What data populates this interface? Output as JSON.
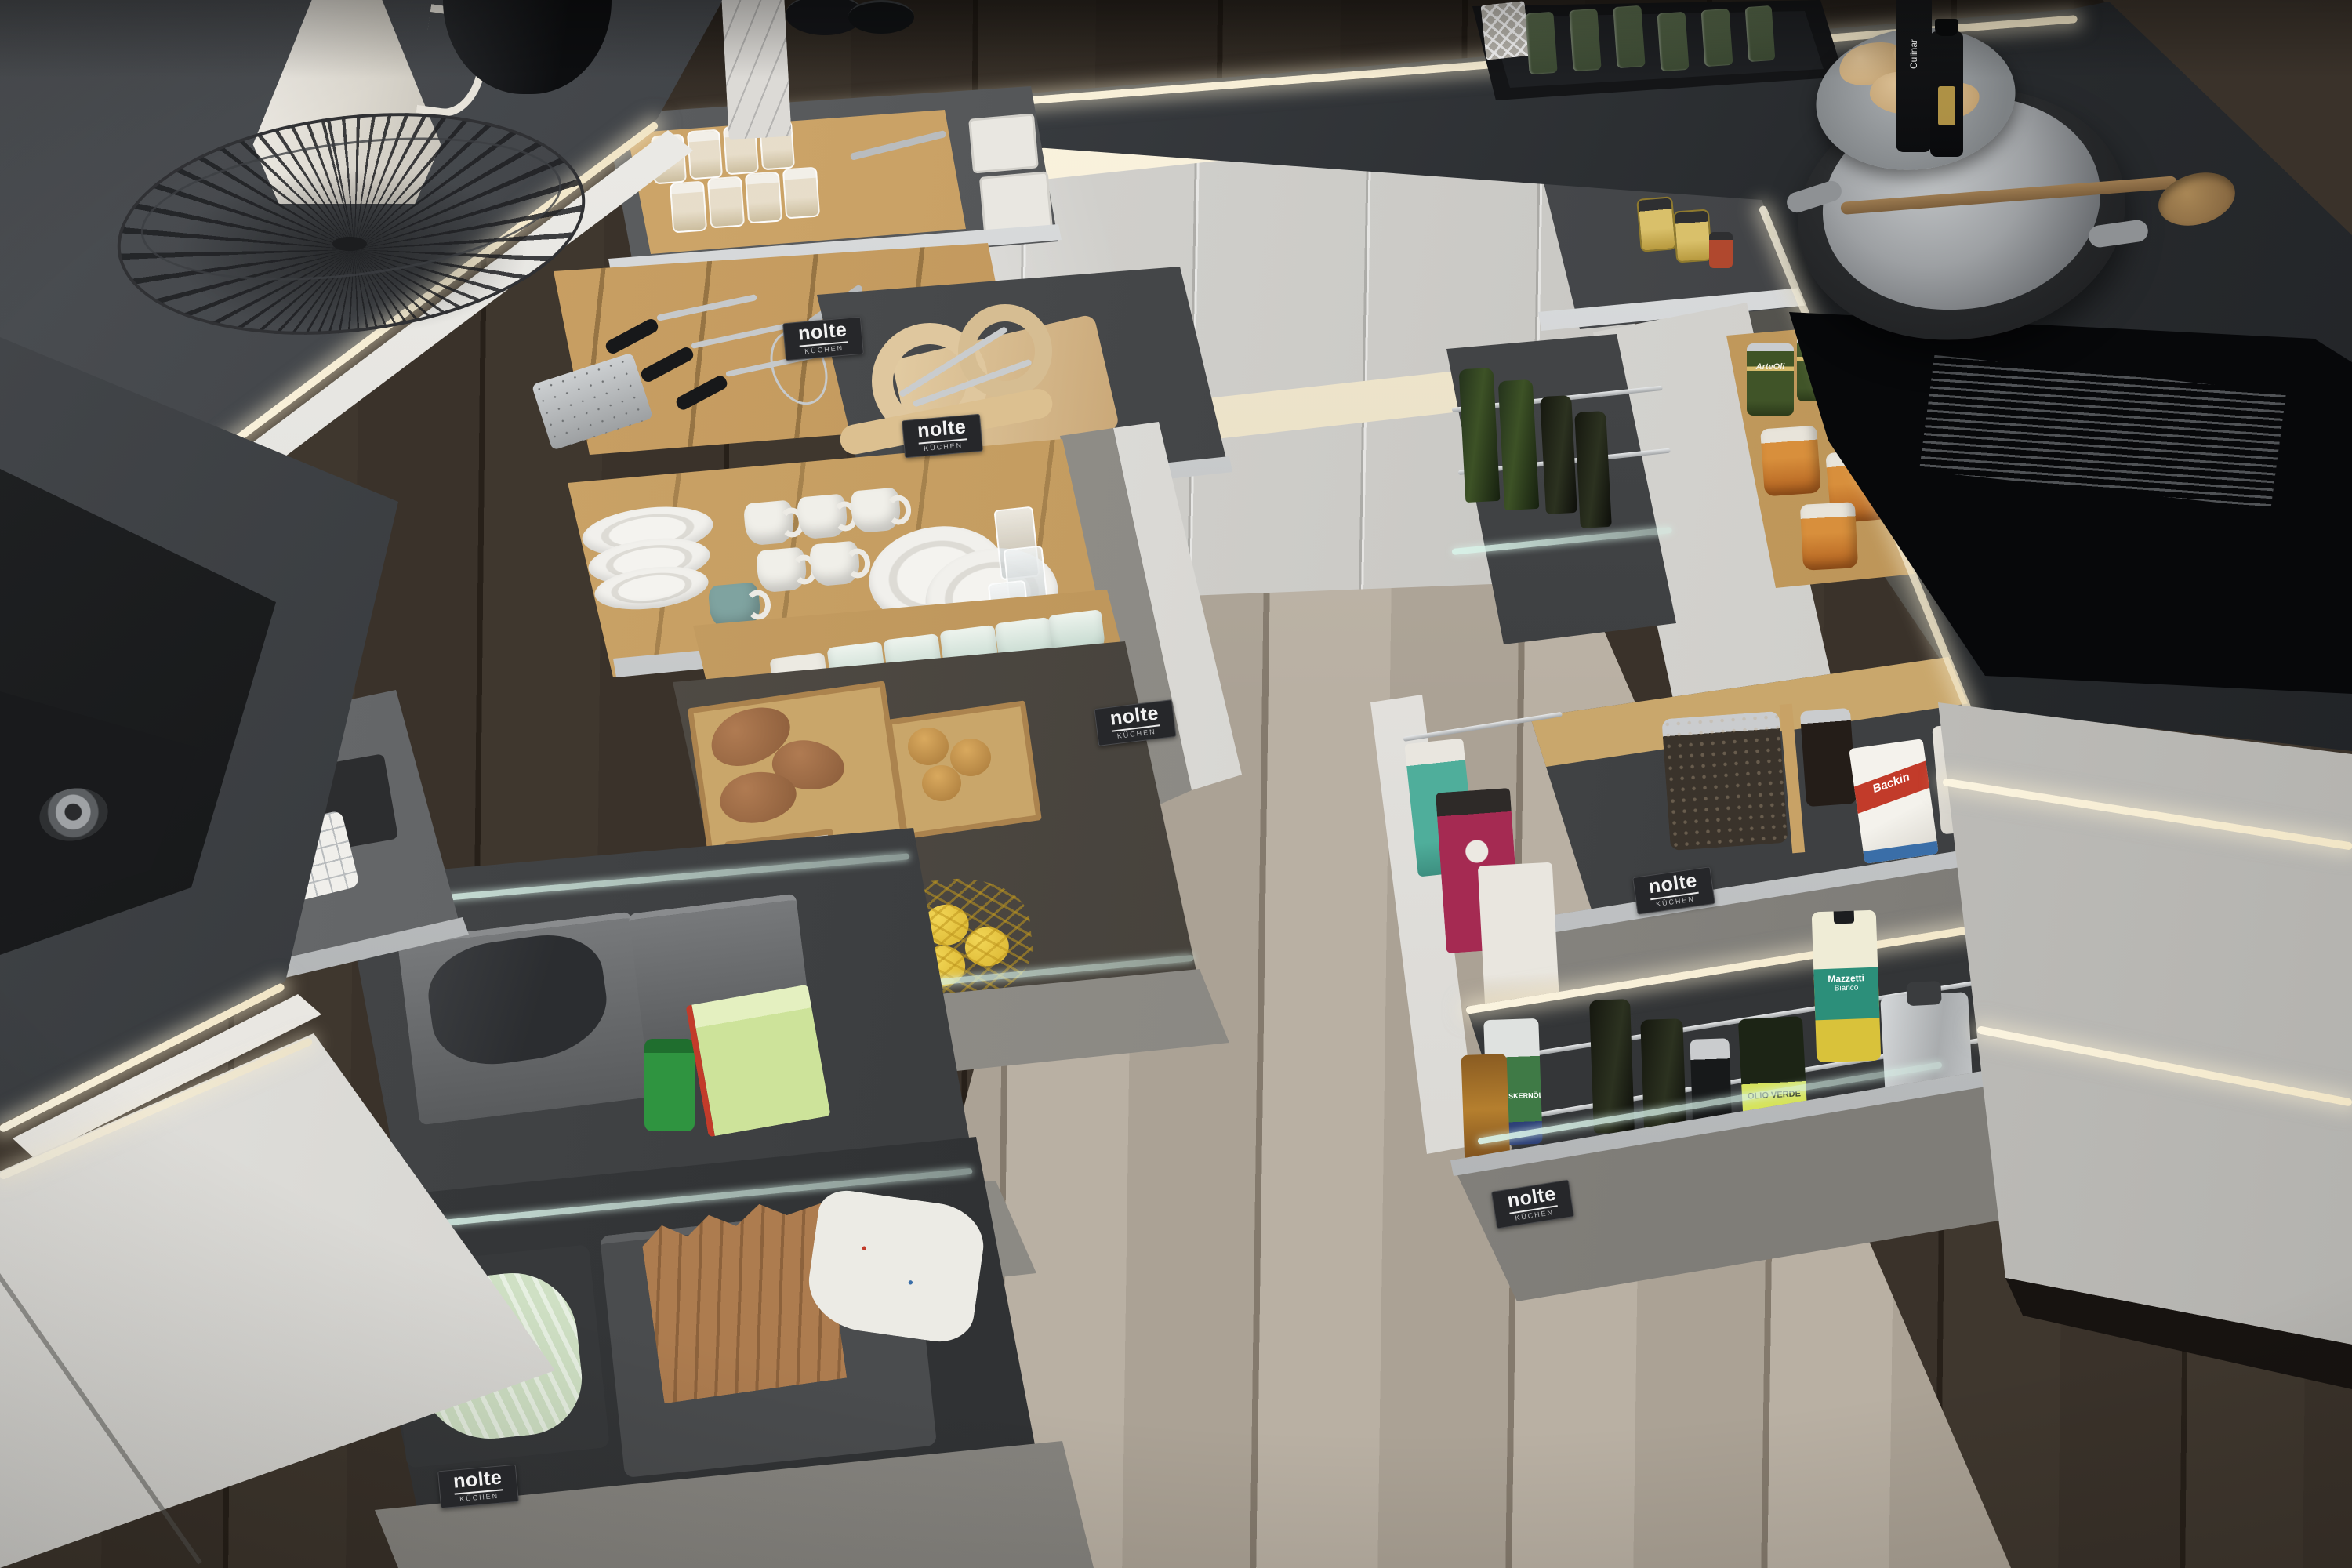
{
  "scene": {
    "title": "Nolte kitchen with fully organised open drawers",
    "setting": "U-shaped kitchen seen from above at an angle; every drawer pulled open to reveal organised contents; LED under-counter lighting; dark oak floor"
  },
  "brand": {
    "name": "nolte",
    "subtitle": "KÜCHEN"
  },
  "products": {
    "olive_cans": "ArteOli",
    "vinegar_brand": "Mazzetti",
    "vinegar_variant": "Bianco",
    "olive_oil_label": "OLIO VERDE",
    "baking_mix": "Backin",
    "pumpkin_seed_oil": "KÜRBISKERNÖL",
    "sauce_bottle": "Culinar"
  },
  "palette": {
    "countertop": "#2b2e31",
    "cabinet_gloss": "#d6d5d1",
    "drawer_gray": "#8f8d88",
    "oak_organizer": "#c9a76c",
    "led_light": "#f7efd9",
    "floor_dark": "#3a322a",
    "floor_light": "#b2a99c",
    "sink_black": "#0e0f10"
  },
  "objects": [
    "wok pan on induction hob",
    "ribbed grill plate",
    "black undermount sink",
    "wire fruit basket",
    "white ceramic jug",
    "black bowls",
    "marble board",
    "cutlery drawer with oak organisers",
    "glass storage jars",
    "knives",
    "grater",
    "whisk",
    "wooden cutting boards",
    "rolling pin",
    "coffee mugs",
    "stacked plates",
    "drinking glasses",
    "pastel cups",
    "sweet potatoes",
    "onions",
    "red onions",
    "garlic",
    "lemons in a net",
    "cleaning drawer with bins and dish soap",
    "waste drawer with liner bags and paper bag",
    "checkered dish towels",
    "olive oil and vinegar bottles in wire pull-out",
    "olive cans",
    "preserve jars",
    "mustard jars",
    "jar of lentils",
    "baking mix packet",
    "pasta bags",
    "tray with green glass bottles",
    "wooden spoon",
    "ginger root on plate",
    "sauce bottles"
  ]
}
